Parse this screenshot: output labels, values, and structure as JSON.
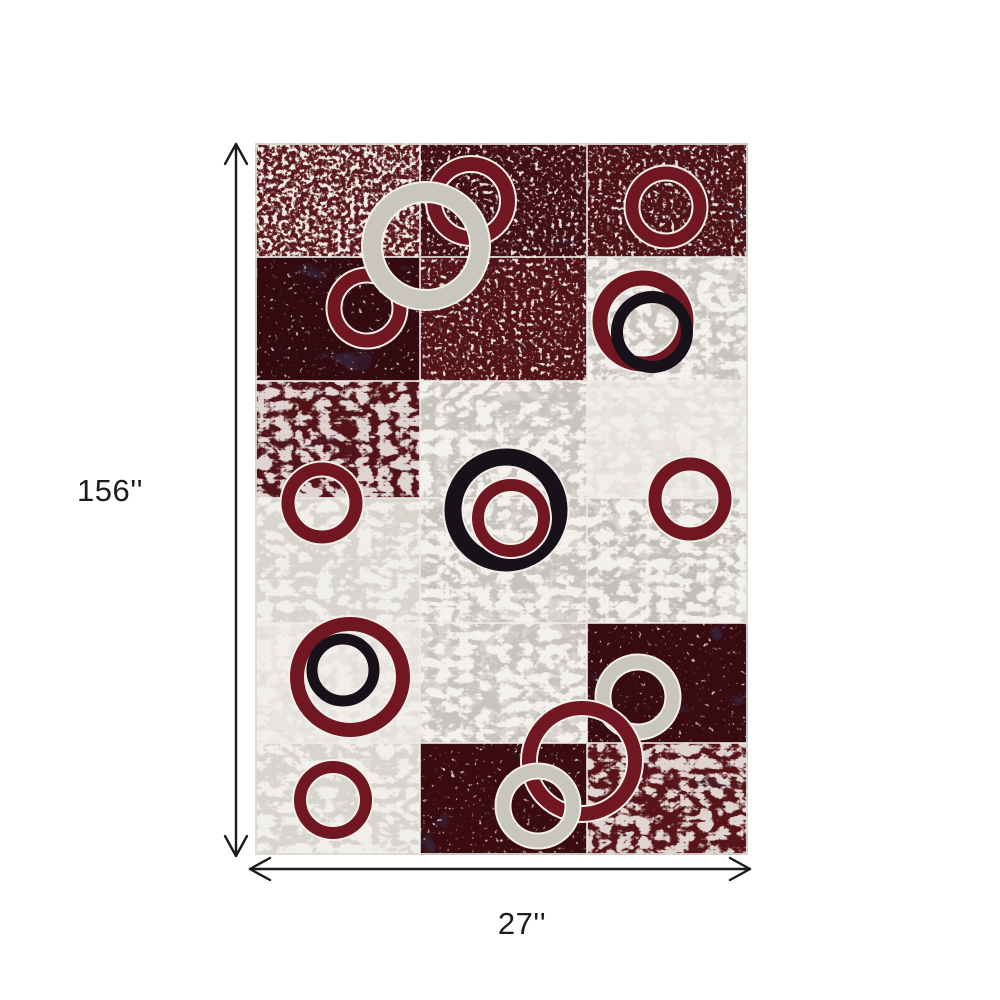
{
  "page": {
    "background": "#ffffff"
  },
  "dimensions": {
    "height_label": "156''",
    "width_label": "27''",
    "arrow_color": "#1b1b1b",
    "text_color": "#1c1c1c"
  },
  "rug": {
    "columns_px": [
      0,
      165,
      332,
      493
    ],
    "rows_px": [
      0,
      114,
      238,
      355,
      480,
      600,
      712
    ],
    "palette": {
      "burgundy": "#701722",
      "gray": "#c9c6be",
      "black": "#171119",
      "ring_outline": "#f2efe9",
      "grid_line": "#efece7",
      "edge": "#dcd9d3"
    },
    "textures": {
      "redLight": {
        "base": "#5b191d",
        "ov": [
          [
            "f-marble-k",
            0.35
          ],
          [
            "f-speck-hi",
            0.95
          ]
        ]
      },
      "redMed": {
        "base": "#4e1318",
        "ov": [
          [
            "f-marble-k",
            0.5
          ],
          [
            "f-speck-md",
            0.9
          ]
        ]
      },
      "redDark": {
        "base": "#370b10",
        "ov": [
          [
            "f-marble-k",
            0.75
          ],
          [
            "f-speck-lo",
            0.8
          ]
        ]
      },
      "redVein": {
        "base": "#531419",
        "ov": [
          [
            "f-marble-k",
            0.4
          ],
          [
            "f-vein-w",
            0.85
          ]
        ]
      },
      "gray": {
        "base": "#c7c3bd",
        "ov": [
          [
            "f-vein-g",
            0.7
          ],
          [
            "f-vein-w",
            0.9
          ]
        ]
      },
      "grayLight": {
        "base": "#d8d5cf",
        "ov": [
          [
            "f-vein-w",
            0.8
          ]
        ]
      },
      "white": {
        "base": "#e8e5e0",
        "ov": [
          [
            "f-vein-g",
            0.45
          ],
          [
            "f-vein-w",
            0.6
          ]
        ]
      }
    },
    "cells": [
      [
        {
          "t": "redLight"
        },
        {
          "t": "redMed",
          "base": "#420f14"
        },
        {
          "t": "redMed"
        }
      ],
      [
        {
          "t": "redDark",
          "base": "#320a0f"
        },
        {
          "t": "redMed",
          "base": "#521419"
        },
        {
          "t": "gray"
        }
      ],
      [
        {
          "t": "redVein"
        },
        {
          "t": "gray"
        },
        {
          "t": "white"
        }
      ],
      [
        {
          "t": "grayLight"
        },
        {
          "t": "gray"
        },
        {
          "t": "gray",
          "base": "#c2beb8"
        }
      ],
      [
        {
          "t": "white"
        },
        {
          "t": "gray"
        },
        {
          "t": "redDark"
        }
      ],
      [
        {
          "t": "grayLight"
        },
        {
          "t": "redDark",
          "base": "#3a0c10"
        },
        {
          "t": "redVein",
          "base": "#571419"
        }
      ]
    ],
    "circles": [
      {
        "cx": 216,
        "cy": 58,
        "r": 37,
        "t": 14,
        "color": "burgundy",
        "outline": true
      },
      {
        "cx": 411,
        "cy": 64,
        "r": 34,
        "t": 13,
        "color": "burgundy",
        "outline": true
      },
      {
        "cx": 112,
        "cy": 165,
        "r": 33,
        "t": 13,
        "color": "burgundy",
        "outline": true
      },
      {
        "cx": 388,
        "cy": 178,
        "r": 43,
        "t": 15,
        "color": "burgundy",
        "outline": true
      },
      {
        "cx": 397,
        "cy": 189,
        "r": 35,
        "t": 12,
        "color": "black",
        "outline": false
      },
      {
        "cx": 171,
        "cy": 103,
        "r": 54,
        "t": 18,
        "color": "gray",
        "outline": true
      },
      {
        "cx": 251,
        "cy": 367,
        "r": 53,
        "t": 17,
        "color": "black",
        "outline": true
      },
      {
        "cx": 256,
        "cy": 375,
        "r": 33,
        "t": 12,
        "color": "burgundy",
        "outline": true
      },
      {
        "cx": 67,
        "cy": 360,
        "r": 34,
        "t": 13,
        "color": "burgundy",
        "outline": true
      },
      {
        "cx": 435,
        "cy": 356,
        "r": 35,
        "t": 13,
        "color": "burgundy",
        "outline": true
      },
      {
        "cx": 95,
        "cy": 534,
        "r": 53,
        "t": 14,
        "color": "burgundy",
        "outline": true
      },
      {
        "cx": 88,
        "cy": 527,
        "r": 31,
        "t": 11,
        "color": "black",
        "outline": false
      },
      {
        "cx": 78,
        "cy": 657,
        "r": 33,
        "t": 12,
        "color": "burgundy",
        "outline": true
      },
      {
        "cx": 383,
        "cy": 554,
        "r": 35,
        "t": 13,
        "color": "gray",
        "outline": true
      },
      {
        "cx": 327,
        "cy": 618,
        "r": 53,
        "t": 14,
        "color": "burgundy",
        "outline": true
      },
      {
        "cx": 283,
        "cy": 663,
        "r": 35,
        "t": 13,
        "color": "gray",
        "outline": true
      }
    ]
  }
}
